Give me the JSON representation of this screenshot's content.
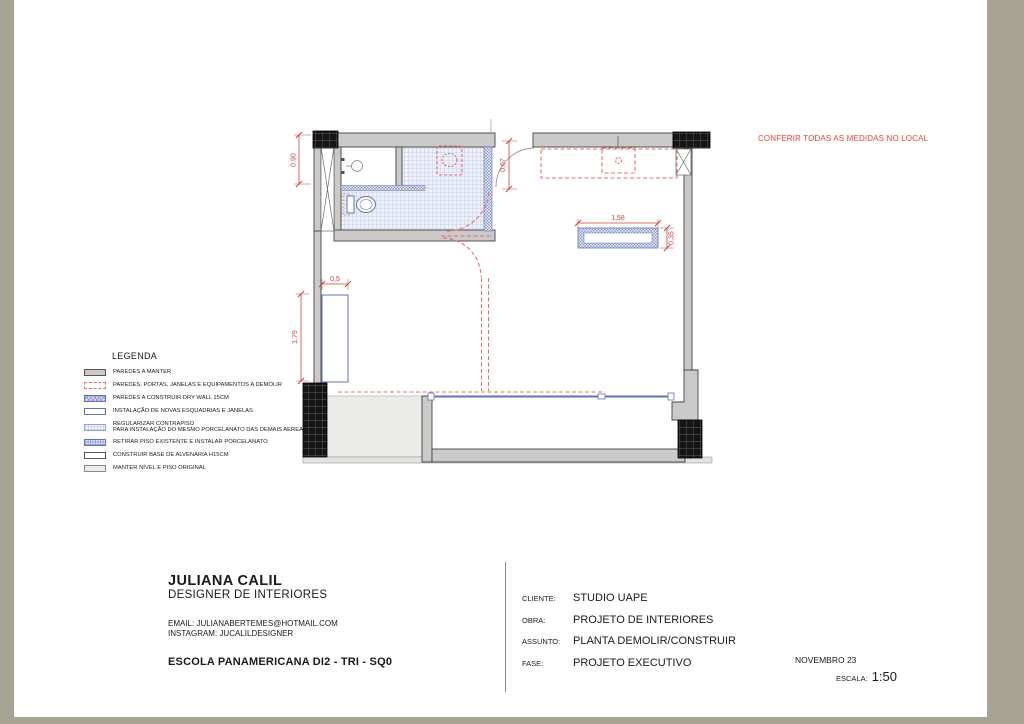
{
  "page": {
    "note": "CONFERIR TODAS AS MEDIDAS NO LOCAL"
  },
  "legend": {
    "title": "LEGENDA",
    "items": [
      {
        "key": "paredes-manter",
        "label": "PAREDES A MANTER"
      },
      {
        "key": "demolir",
        "label": "PAREDES, PORTAS, JANELAS E EQUIPAMENTOS A DEMOLIR"
      },
      {
        "key": "drywall",
        "label": "PAREDES A CONSTRUIR DRY WALL 15CM"
      },
      {
        "key": "esquadrias",
        "label": "INSTALAÇÃO DE NOVAS ESQUADRIAS E JANELAS"
      },
      {
        "key": "contrapiso",
        "label": "REGULARIZAR CONTRAPISO",
        "label2": "PARA INSTALAÇÃO DO MESMO PORCELANATO DAS DEMAIS AEREAS"
      },
      {
        "key": "porcelanato",
        "label": "RETIRAR PISO EXISTENTE E INSTALAR PORCELANATO"
      },
      {
        "key": "base-alvenaria",
        "label": "CONSTRUIR BASE DE ALVENARIA H15CM"
      },
      {
        "key": "piso-original",
        "label": "MANTER NÍVEL E PISO ORIGINAL"
      }
    ]
  },
  "plan": {
    "dims": {
      "d090": "0,90",
      "d067": "0,67",
      "d158": "1,58",
      "d035": "0,35",
      "d05": "0,5",
      "d179": "1,79"
    }
  },
  "titleblock": {
    "designer_name": "JULIANA CALIL",
    "designer_role": "DESIGNER DE INTERIORES",
    "email_line": "EMAIL: JULIANABERTEMES@HOTMAIL.COM",
    "instagram_line": "INSTAGRAM: JUCALILDESIGNER",
    "project_title": "ESCOLA PANAMERICANA DI2 - TRI - SQ0",
    "fields": [
      {
        "label": "CLIENTE:",
        "value": "STUDIO UAPE"
      },
      {
        "label": "OBRA:",
        "value": "PROJETO DE INTERIORES"
      },
      {
        "label": "ASSUNTO:",
        "value": "PLANTA DEMOLIR/CONSTRUIR"
      },
      {
        "label": "FASE:",
        "value": "PROJETO EXECUTIVO"
      }
    ],
    "date": "NOVEMBRO 23",
    "scale_label": "ESCALA:",
    "scale_value": "1:50"
  },
  "colors": {
    "frame_olive": "#a7a494",
    "wall_gray": "#cbcac8",
    "note_red": "#e8433c",
    "dimension_red": "#d0413d",
    "demolish_red": "#e2716e",
    "new_blue": "#6272bd"
  }
}
